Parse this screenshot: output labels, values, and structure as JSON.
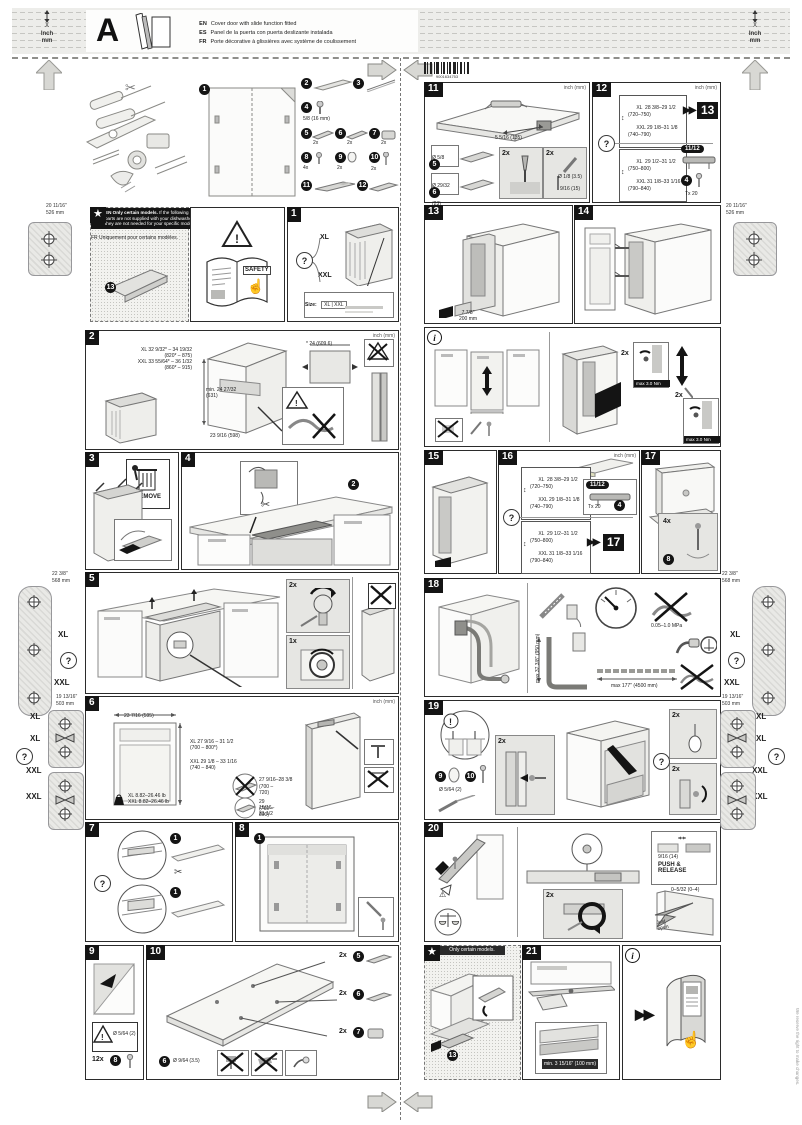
{
  "common": {
    "q": "?",
    "x1": "1x",
    "x2": "2x",
    "x4": "4x",
    "x12": "12x",
    "ff": "▶▶",
    "unit": "inch (mm)",
    "torque": "max 3.0 Nm",
    "xl": "XL",
    "xxl": "XXL"
  },
  "corner_units": {
    "x": "X",
    "inch": "Inch",
    "mm": "mm"
  },
  "header": {
    "letter": "A",
    "lines": [
      {
        "lang": "EN",
        "text": "Cover door with slide function fitted"
      },
      {
        "lang": "ES",
        "text": "Panel de la puerta con puerta deslizante instalada"
      },
      {
        "lang": "FR",
        "text": "Porte décorative à glissières avec système de coulissement"
      }
    ]
  },
  "barcode_number": "9001634753",
  "overview": {
    "template_num": "1",
    "parts": [
      {
        "n": "2",
        "q": ""
      },
      {
        "n": "3",
        "q": ""
      },
      {
        "n": "4",
        "q": "5/8 (16 mm)"
      },
      {
        "n": "5",
        "q": "2x"
      },
      {
        "n": "6",
        "q": "2x"
      },
      {
        "n": "7",
        "q": "2x"
      },
      {
        "n": "8",
        "q": "4x"
      },
      {
        "n": "9",
        "q": "2x"
      },
      {
        "n": "10",
        "q": "2x"
      },
      {
        "n": "11",
        "q": ""
      },
      {
        "n": "12",
        "q": ""
      }
    ]
  },
  "star_note": {
    "badge": "★",
    "en_title": "EN  Only certain models.",
    "en_body": "If the following parts are not supplied with your dishwasher, they are not needed for your specific model.",
    "es": "ES   Sólo se aplica a determinados modelos.",
    "fr": "FR   Uniquement pour certains modèles.",
    "part": "13"
  },
  "safety": {
    "label": "SAFETY"
  },
  "panels": {
    "p1": {
      "num": "1",
      "size_label": "Size:",
      "size_value": "XL | XXL"
    },
    "p2": {
      "num": "2",
      "l1": "XL 32 9/32* – 34 19/32",
      "l2": "(820* – 875)",
      "l3": "XXL 33 55/64* – 36 1/32",
      "l4": "(860* – 915)",
      "depth": "min. 24 27/32\n(631)",
      "floor": "23 9/16 (598)",
      "width_note": "* 24 (609.6)"
    },
    "p3": {
      "num": "3",
      "remove": "REMOVE"
    },
    "p4": {
      "num": "4",
      "part": "2"
    },
    "p5": {
      "num": "5"
    },
    "p6": {
      "num": "6",
      "width": "23 7/16 (595)",
      "xl1": "XL  27 9/16 – 31 1/2",
      "xl2": "(700 – 800*)",
      "xxl1": "XXL  29 1/8 – 33 1/16",
      "xxl2": "(740 – 840)",
      "wxl": "XL  8.82–26.46 lb",
      "wxxl": "XXL  8.82–26.46 lb",
      "no1a": "27 9/16–28 3/8",
      "no1b": "(700 – 720)",
      "no2a": "29 15/16–31 1/2",
      "no2b": "(760 – 800)"
    },
    "p7": {
      "num": "7",
      "t": "1"
    },
    "p8": {
      "num": "8",
      "t": "1"
    },
    "p9": {
      "num": "9",
      "part": "8",
      "drill": "Ø 5/64 (2)"
    },
    "p10": {
      "num": "10",
      "p5": "5",
      "p6": "6",
      "p7": "7",
      "note": "Ø 9/64 (3.5)"
    },
    "p11": {
      "num": "11",
      "dim": "5 5/16 (135)",
      "p5": "5",
      "p5d": "Ø 5/8 (16.5)",
      "p6": "6",
      "p6d": "Ø 29/32 (23)",
      "drill": "Ø 1/8 (3.5)",
      "depth": "9/16 (15)"
    },
    "p12": {
      "num": "12",
      "a1": "XL  28 3/8–29 1/2",
      "a2": "(720–750)",
      "a3": "XXL 29 1/8–31 1/8",
      "a4": "(740–790)",
      "goto": "13",
      "b1": "XL  29 1/2–31 1/2",
      "b2": "(750–800)",
      "b3": "XXL 31 1/8–33 1/16",
      "b4": "(790–840)",
      "rail": "11/12",
      "screw": "4",
      "tool": "Tx 20"
    },
    "p13": {
      "num": "13",
      "d1": "7 7/8\"",
      "d2": "200 mm"
    },
    "p14": {
      "num": "14"
    },
    "i1": {
      "icon": "i"
    },
    "p15": {
      "num": "15"
    },
    "p16": {
      "num": "16",
      "a1": "XL  28 3/8–29 1/2",
      "a2": "(720–750)",
      "a3": "XXL 29 1/8–31 1/8",
      "a4": "(740–790)",
      "rail": "11/12",
      "screw": "4",
      "tool": "Tx 20",
      "b1": "XL  29 1/2–31 1/2",
      "b2": "(750–800)",
      "b3": "XXL 31 1/8–33 1/16",
      "b4": "(790–840)",
      "goto": "17"
    },
    "p17": {
      "num": "17",
      "part": "8"
    },
    "p18": {
      "num": "18",
      "mpa": "0.05–1.0 MPa",
      "h": "max 37 3/8\" (950 mm)",
      "len": "max 177\" (4500 mm)"
    },
    "p19": {
      "num": "19",
      "alert": "!",
      "p9": "9",
      "p10": "10",
      "drill": "Ø 5/64 (2)"
    },
    "p20": {
      "num": "20",
      "push": "PUSH &\nRELEASE",
      "gap": "9/16 (14)",
      "gap2": "0–5/32 (0–4)",
      "sticker": "Just\nopen"
    },
    "star2": {
      "title": "Only certain models.",
      "part": "13"
    },
    "p21": {
      "num": "21",
      "dim": "min. 3 15/16\" (100 mm)"
    },
    "i2": {
      "icon": "i"
    }
  },
  "margins": {
    "top1": "20 11/16\"",
    "top2": "526 mm",
    "rail1": "22 3/8\"",
    "rail2": "568 mm",
    "hinge1": "19 13/16\"",
    "hinge2": "503 mm"
  },
  "footer": {
    "note": "We reserve the right to make changes."
  }
}
